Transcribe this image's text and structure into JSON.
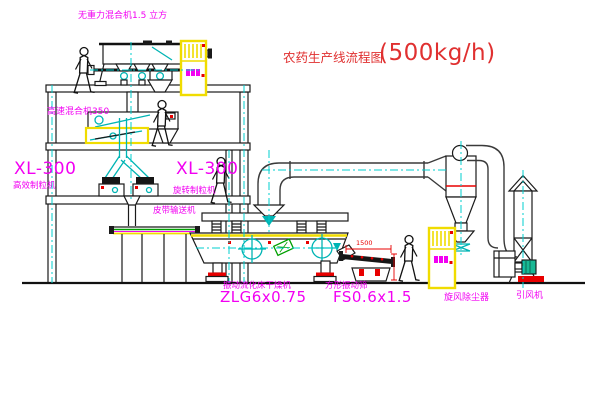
{
  "diagram": {
    "title": {
      "text": "农药生产线流程图",
      "capacity": "(500kg/h)"
    },
    "labels": {
      "zero_gravity_mixer": "无重力混合机1.5 立方",
      "high_speed_mixer": "高速混合机350",
      "granulator_left_model": "XL-300",
      "granulator_left_name": "高效制粒机",
      "granulator_right_model": "XL-300",
      "granulator_right_name": "旋转制粒机",
      "belt_conveyor": "皮带输送机",
      "dryer_name": "振动流化床干燥机",
      "dryer_model": "ZLG6x0.75",
      "sieve_name": "方形振动筛",
      "sieve_model": "FS0.6x1.5",
      "sieve_dimension": "1500",
      "cyclone": "旋风除尘器",
      "induced_draft_fan": "引风机"
    },
    "colors": {
      "label_magenta": "#F200F2",
      "title_red": "#E03030",
      "dimension_red": "#E80000",
      "equipment_teal": "#00B4B4",
      "highlight_yellow": "#F0DC00",
      "accent_green": "#00A000",
      "line_black": "#1A1A1A"
    }
  }
}
